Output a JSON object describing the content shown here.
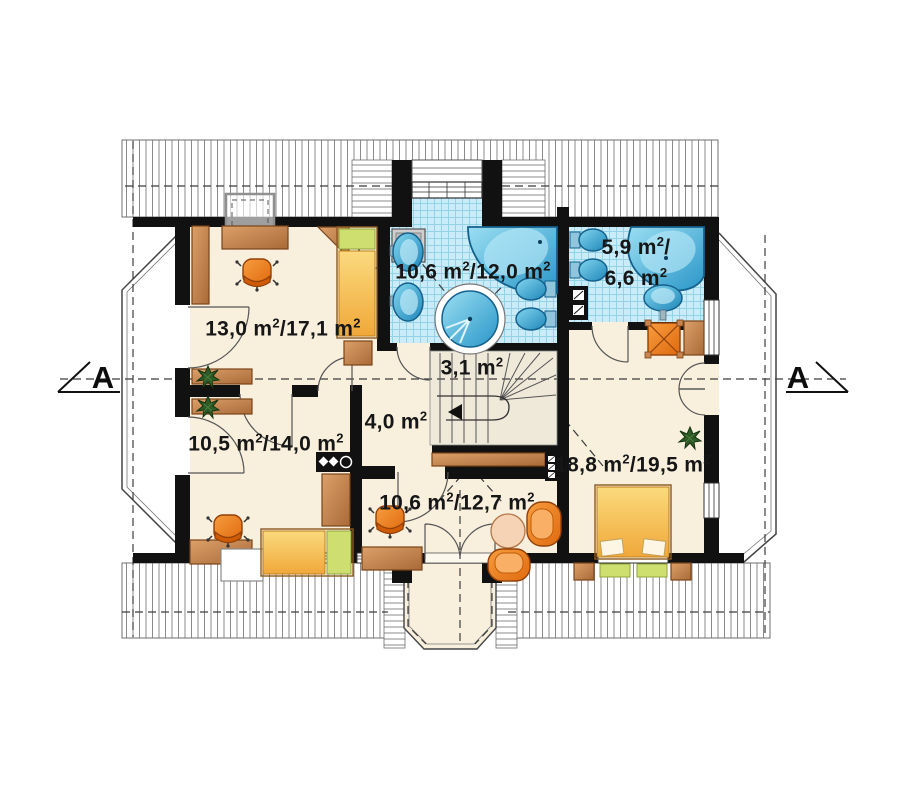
{
  "plan": {
    "type": "floor-plan",
    "section_marker_left": "A",
    "section_marker_right": "A",
    "rooms": [
      {
        "id": "room-upper-left",
        "area_label": "13,0 m²/17,1 m²"
      },
      {
        "id": "bathroom-main",
        "area_label": "10,6 m²/12,0 m²"
      },
      {
        "id": "bathroom-small",
        "area_label_line1": "5,9 m²/",
        "area_label_line2": "6,6 m²"
      },
      {
        "id": "staircase",
        "area_label": "3,1 m²"
      },
      {
        "id": "hall",
        "area_label": "4,0 m²"
      },
      {
        "id": "room-lower-left",
        "area_label": "10,5 m²/14,0 m²"
      },
      {
        "id": "room-lower-middle",
        "area_label": "10,6 m²/12,7 m²"
      },
      {
        "id": "bedroom-right",
        "area_label": "18,8 m²/19,5 m²"
      }
    ],
    "colors": {
      "floor": "#f8efdd",
      "wall": "#111111",
      "tile": "#c9ecf8",
      "fixture_blue": "#2a9fd0",
      "furniture_brown": "#c9854f",
      "chair_orange": "#ef7d1d",
      "bed_yellow": "#f5b945",
      "pillow_green": "#cede6f"
    }
  }
}
